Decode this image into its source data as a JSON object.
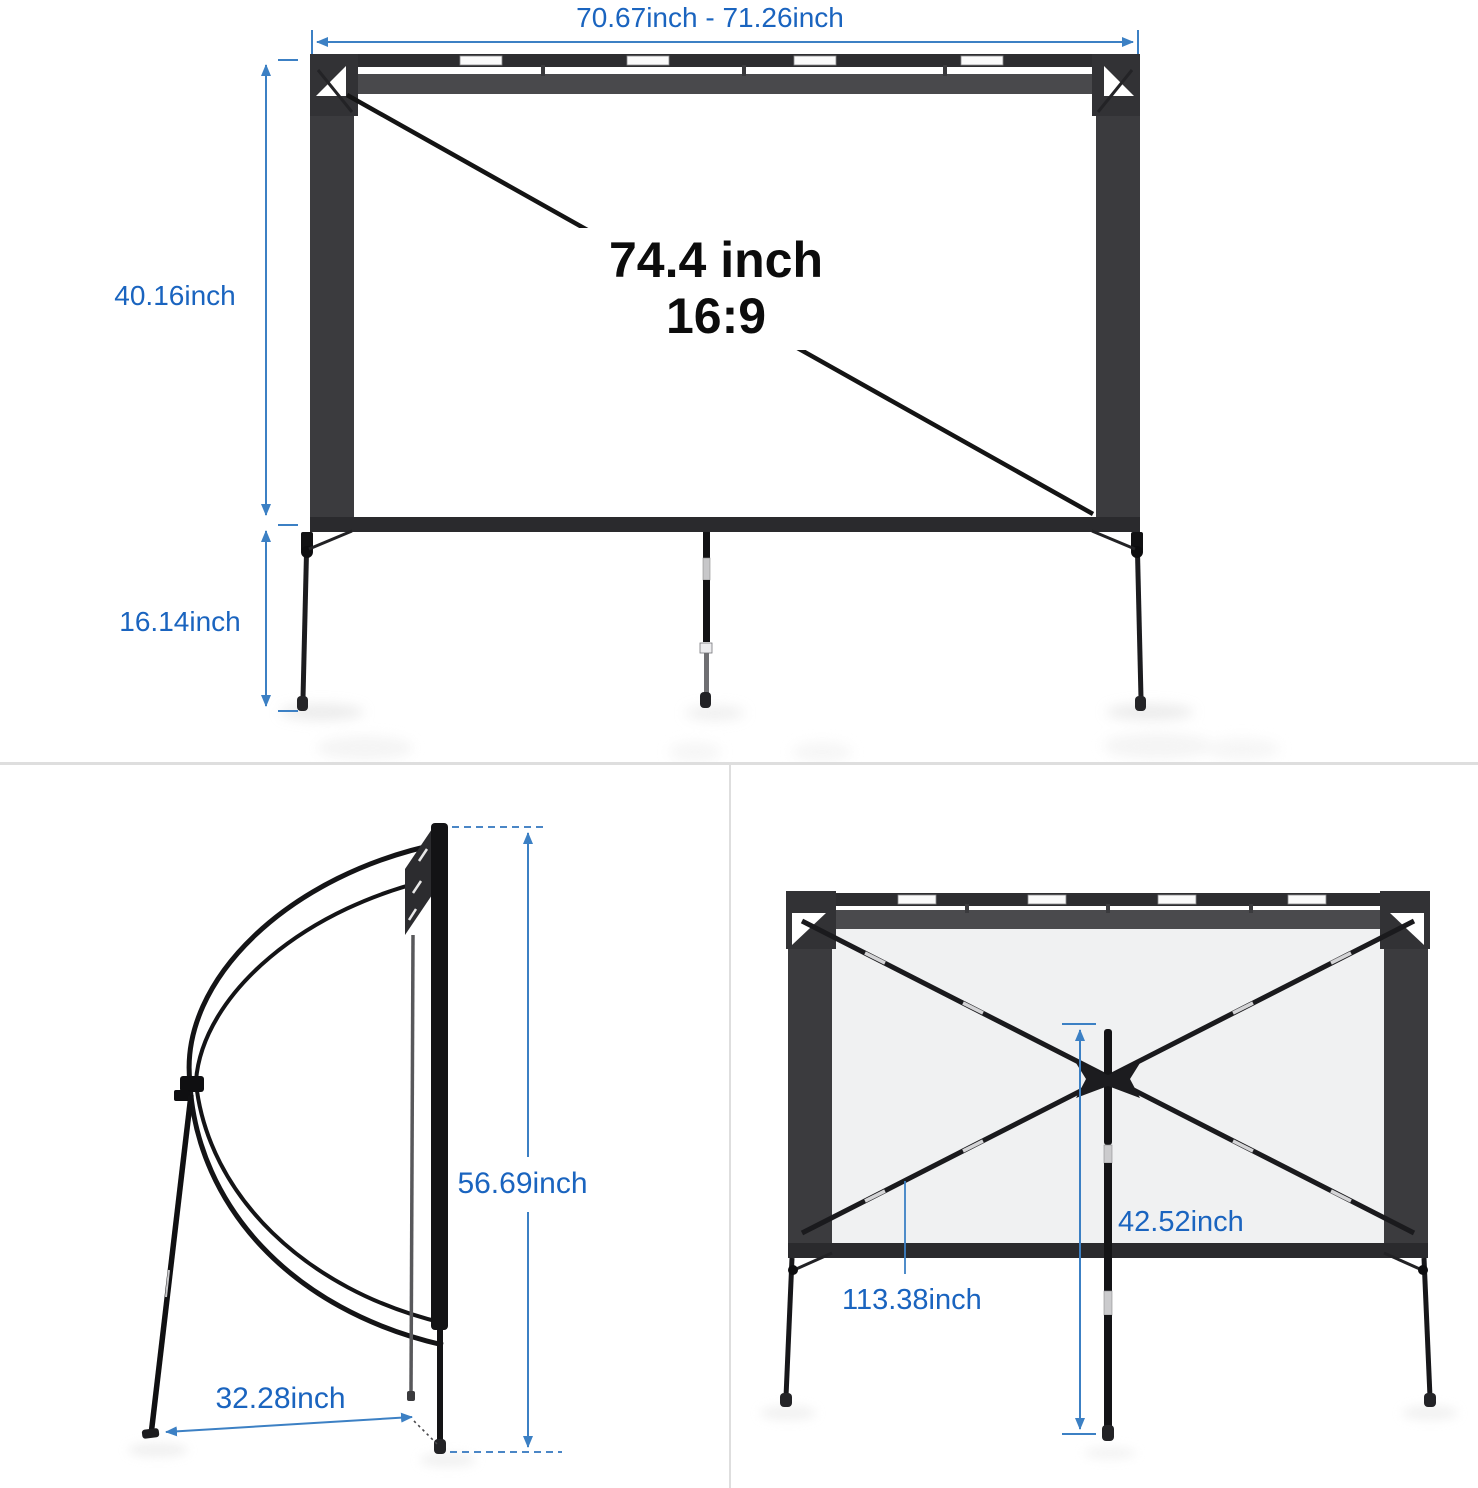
{
  "colors": {
    "dimension_blue": "#3c80c4",
    "label_blue": "#1a64bf",
    "frame_dark": "#3b3b3e",
    "rail_dark": "#2d2d30",
    "diagonal_text_black": "#0c0c0c"
  },
  "front_view": {
    "width_label": "70.67inch - 71.26inch",
    "screen_height_label": "40.16inch",
    "stand_height_label": "16.14inch",
    "diagonal_size_label": "74.4 inch",
    "aspect_ratio_label": "16:9"
  },
  "side_view": {
    "total_height_label": "56.69inch",
    "base_depth_label": "32.28inch"
  },
  "back_view": {
    "center_height_label": "42.52inch",
    "crossbar_length_label": "113.38inch"
  }
}
